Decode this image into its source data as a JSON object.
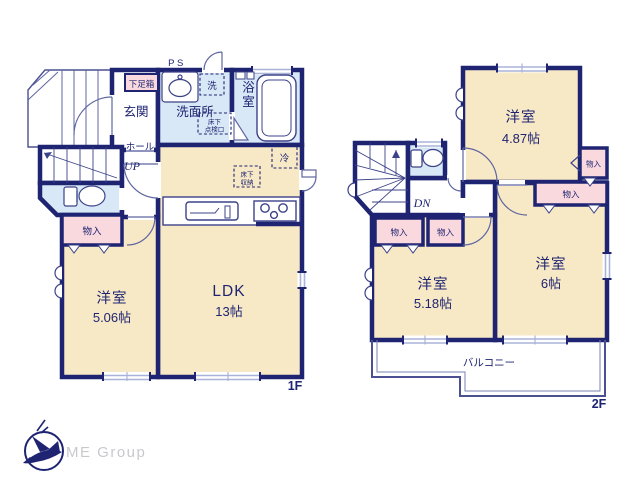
{
  "floor1": {
    "floor_label": "1F",
    "ps_label": "PS",
    "shoe_box": "下足箱",
    "entrance": "玄関",
    "laundry": "洗",
    "washroom": "洗面所",
    "inspection_hatch_line1": "床下",
    "inspection_hatch_line2": "点検口",
    "bath": "浴室",
    "hall": "ホール",
    "stairs_up": "UP",
    "fridge": "冷",
    "underfloor_storage_line1": "床下",
    "underfloor_storage_line2": "収納",
    "closet": "物入",
    "western_room": {
      "name": "洋室",
      "size": "5.06帖"
    },
    "ldk": {
      "name": "LDK",
      "size": "13帖"
    }
  },
  "floor2": {
    "floor_label": "2F",
    "stairs_down": "DN",
    "western_room_a": {
      "name": "洋室",
      "size": "4.87帖"
    },
    "western_room_b": {
      "name": "洋室",
      "size": "5.18帖"
    },
    "western_room_c": {
      "name": "洋室",
      "size": "6帖"
    },
    "closet_a": "物入",
    "closet_b": "物入",
    "closet_c": "物入",
    "closet_d": "物入",
    "balcony": "バルコニー"
  },
  "logo": {
    "company": "ME Group"
  },
  "colors": {
    "wall_navy": "#1e2472",
    "room_cream": "#f8e9c6",
    "wet_area_blue": "#d9e8f6",
    "closet_pink": "#f9d8de",
    "window_line": "#a9b3d8",
    "logo_text_gray": "#c9c9cc"
  }
}
